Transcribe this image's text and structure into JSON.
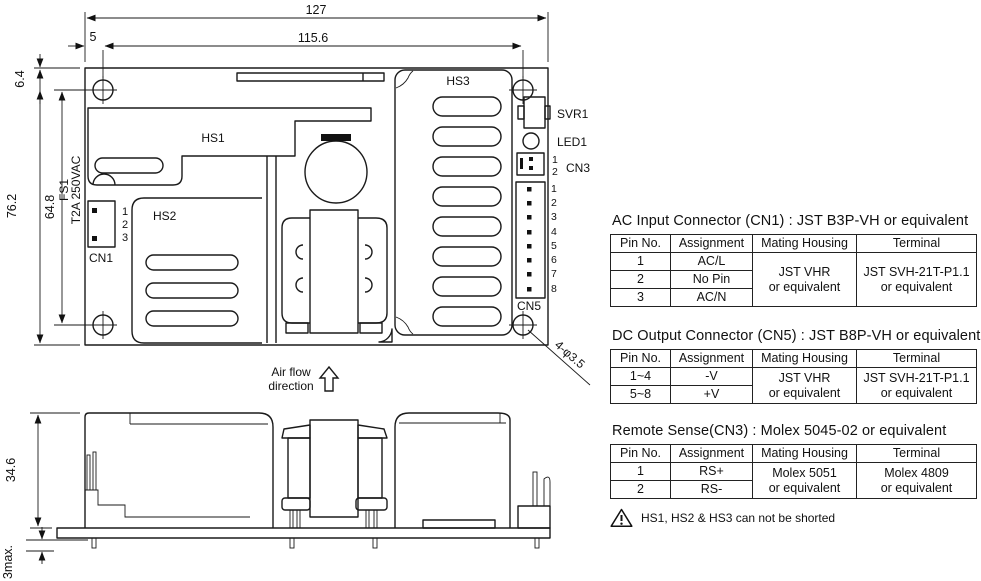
{
  "drawing": {
    "dimensions": {
      "overall_width": "127",
      "hole_span_width": "115.6",
      "hole_offset_x": "5",
      "overall_height": "76.2",
      "hole_span_height": "64.8",
      "hole_offset_y": "6.4",
      "side_height": "34.6",
      "pin_protrusion": "3max.",
      "mounting_holes": "4-φ3.5"
    },
    "labels": {
      "hs1": "HS1",
      "hs2": "HS2",
      "hs3": "HS3",
      "fuse_ref": "FS1",
      "fuse_rating": "T2A 250VAC",
      "cn1": "CN1",
      "cn3": "CN3",
      "cn5": "CN5",
      "svr1": "SVR1",
      "led1": "LED1",
      "airflow_line1": "Air flow",
      "airflow_line2": "direction"
    },
    "pins": {
      "cn1": [
        "1",
        "2",
        "3"
      ],
      "cn3": [
        "1",
        "2"
      ],
      "cn5": [
        "1",
        "2",
        "3",
        "4",
        "5",
        "6",
        "7",
        "8"
      ]
    }
  },
  "connector_tables": [
    {
      "title": "AC Input Connector (CN1) : JST B3P-VH or equivalent",
      "headers": [
        "Pin No.",
        "Assignment",
        "Mating Housing",
        "Terminal"
      ],
      "rows": [
        {
          "pin": "1",
          "assignment": "AC/L"
        },
        {
          "pin": "2",
          "assignment": "No Pin"
        },
        {
          "pin": "3",
          "assignment": "AC/N"
        }
      ],
      "mating_housing": "JST VHR\nor equivalent",
      "terminal": "JST SVH-21T-P1.1\nor equivalent"
    },
    {
      "title": "DC Output Connector (CN5) : JST B8P-VH or equivalent",
      "headers": [
        "Pin No.",
        "Assignment",
        "Mating Housing",
        "Terminal"
      ],
      "rows": [
        {
          "pin": "1~4",
          "assignment": "-V"
        },
        {
          "pin": "5~8",
          "assignment": "+V"
        }
      ],
      "mating_housing": "JST VHR\nor equivalent",
      "terminal": "JST SVH-21T-P1.1\nor equivalent"
    },
    {
      "title": "Remote Sense(CN3) : Molex 5045-02 or equivalent",
      "headers": [
        "Pin No.",
        "Assignment",
        "Mating Housing",
        "Terminal"
      ],
      "rows": [
        {
          "pin": "1",
          "assignment": "RS+"
        },
        {
          "pin": "2",
          "assignment": "RS-"
        }
      ],
      "mating_housing": "Molex 5051\nor equivalent",
      "terminal": "Molex 4809\nor equivalent"
    }
  ],
  "note": {
    "text": "HS1, HS2 & HS3 can not be shorted"
  },
  "colors": {
    "line": "#1a1a1a",
    "background": "#ffffff"
  }
}
